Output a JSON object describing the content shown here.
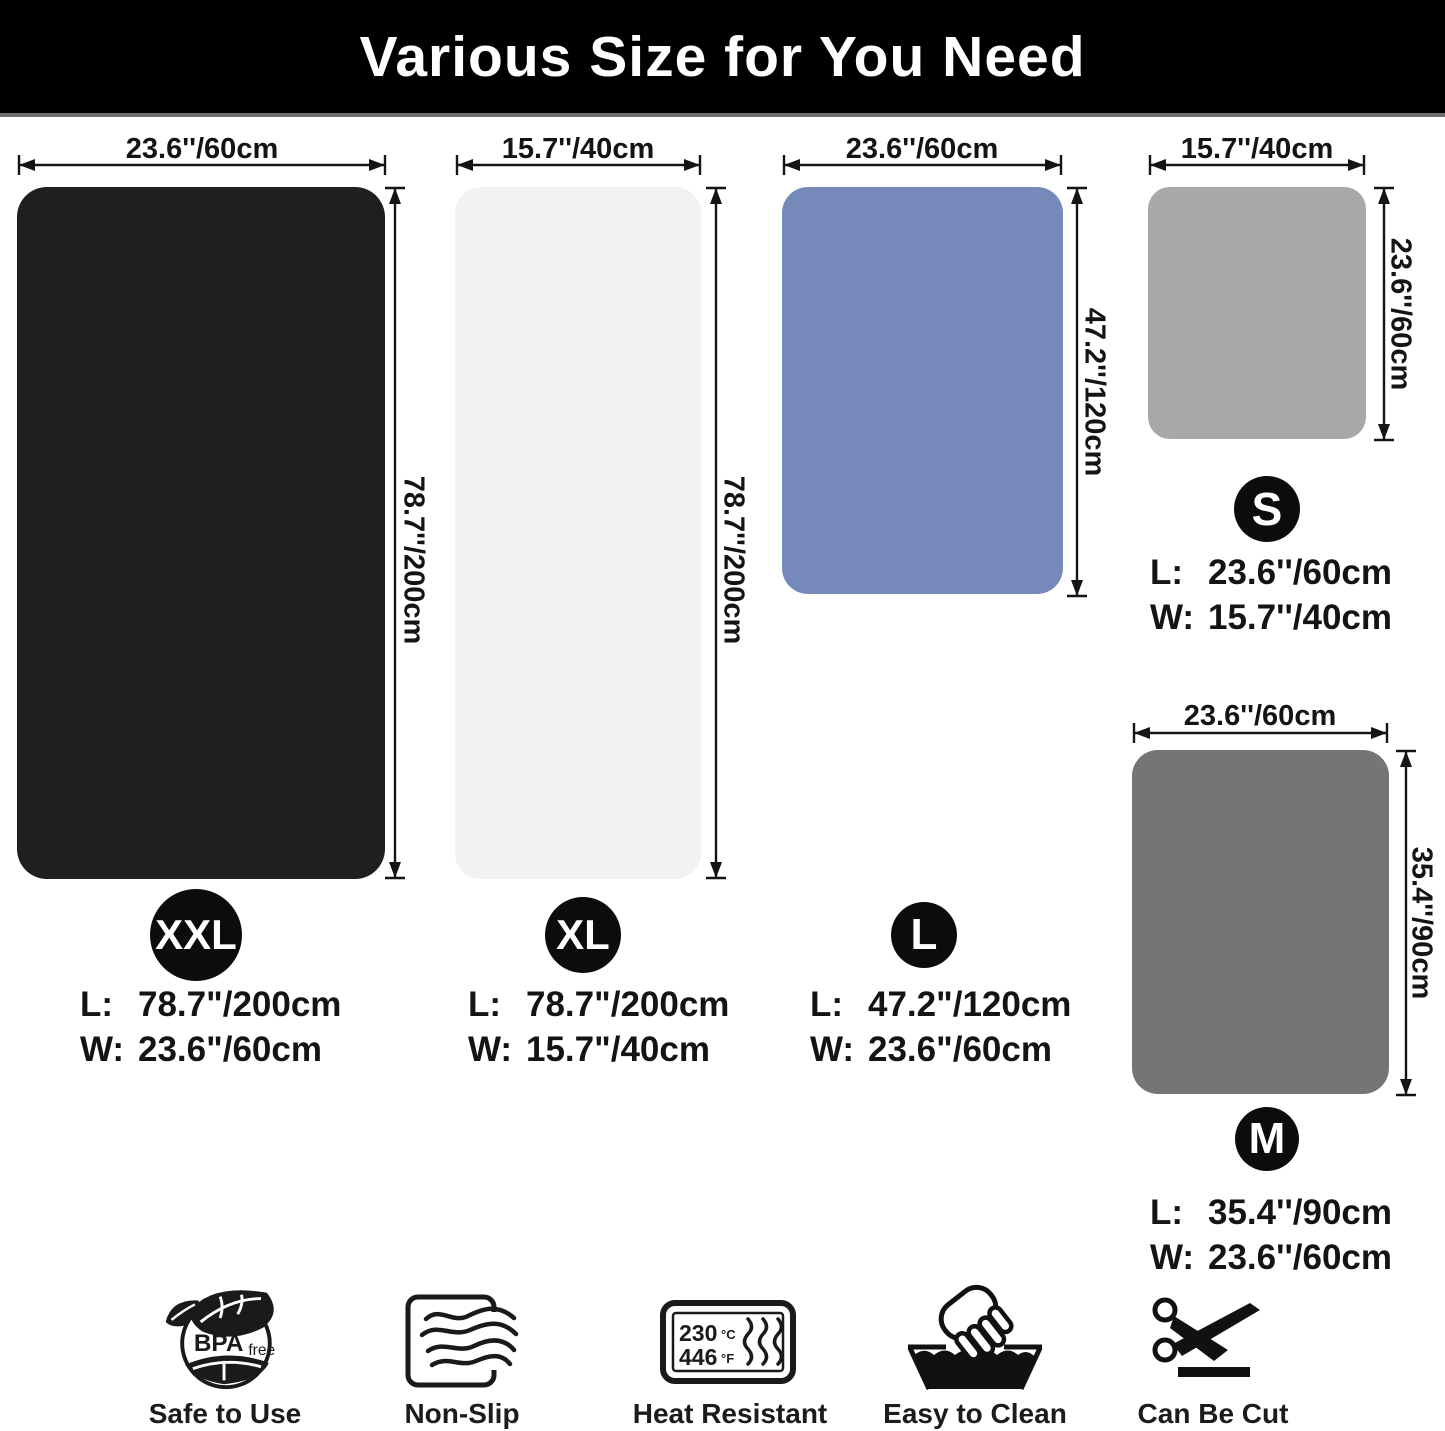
{
  "title": "Various Size for You Need",
  "mats": [
    {
      "id": "XXL",
      "badge": "XXL",
      "color": "#1f1f1f",
      "top_label": "23.6''/60cm",
      "side_label": "78.7''/200cm",
      "l_label": "L:",
      "l_value": "78.7\"/200cm",
      "w_label": "W:",
      "w_value": "23.6\"/60cm"
    },
    {
      "id": "XL",
      "badge": "XL",
      "color": "#f2f2f2",
      "top_label": "15.7''/40cm",
      "side_label": "78.7''/200cm",
      "l_label": "L:",
      "l_value": "78.7\"/200cm",
      "w_label": "W:",
      "w_value": "15.7\"/40cm"
    },
    {
      "id": "L",
      "badge": "L",
      "color": "#7589ba",
      "top_label": "23.6''/60cm",
      "side_label": "47.2''/120cm",
      "l_label": "L:",
      "l_value": "47.2\"/120cm",
      "w_label": "W:",
      "w_value": "23.6\"/60cm"
    },
    {
      "id": "S",
      "badge": "S",
      "color": "#a8a8a8",
      "top_label": "15.7''/40cm",
      "side_label": "23.6''/60cm",
      "l_label": "L:",
      "l_value": "23.6''/60cm",
      "w_label": "W:",
      "w_value": "15.7''/40cm"
    },
    {
      "id": "M",
      "badge": "M",
      "color": "#757575",
      "top_label": "23.6''/60cm",
      "side_label": "35.4''/90cm",
      "l_label": "L:",
      "l_value": "35.4''/90cm",
      "w_label": "W:",
      "w_value": "23.6''/60cm"
    }
  ],
  "features": [
    {
      "icon": "bpa-free-icon",
      "caption": "Safe to Use",
      "text_main": "BPA",
      "text_sub": "free"
    },
    {
      "icon": "non-slip-icon",
      "caption": "Non-Slip"
    },
    {
      "icon": "heat-resistant-icon",
      "caption": "Heat Resistant",
      "c_value": "230",
      "c_unit": "°C",
      "f_value": "446",
      "f_unit": "°F"
    },
    {
      "icon": "easy-to-clean-icon",
      "caption": "Easy to Clean"
    },
    {
      "icon": "scissors-icon",
      "caption": "Can Be Cut"
    }
  ]
}
